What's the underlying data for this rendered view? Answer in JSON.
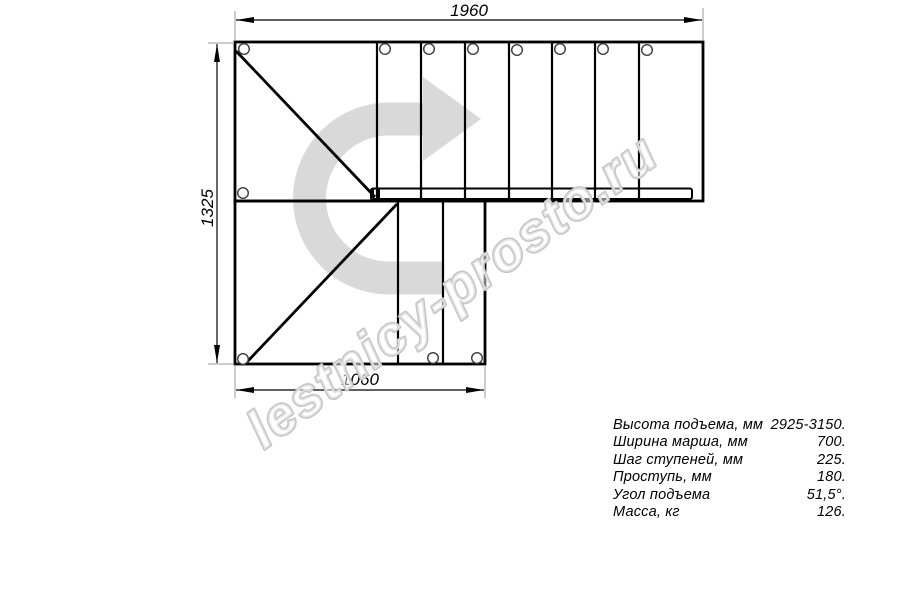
{
  "drawing": {
    "kind": "L-shaped staircase plan view",
    "dimensions": {
      "top": {
        "value": "1960"
      },
      "left": {
        "value": "1325"
      },
      "bottom": {
        "value": "1060"
      }
    },
    "direction_arrow": {
      "name": "direction-of-travel-arrow",
      "color": "#d9d9d9"
    },
    "colors": {
      "line": "#000000",
      "extension_line": "#9a9a9a",
      "hole_stroke": "#3c3c3c",
      "watermark": "#c6c6c6"
    }
  },
  "watermark": {
    "text": "lestnicy-prosto.ru",
    "color": "#c6c6c6"
  },
  "specs": {
    "rows": [
      {
        "label": "Высота подъема, мм",
        "value": "2925-3150."
      },
      {
        "label": "Ширина марша, мм",
        "value": "700."
      },
      {
        "label": "Шаг ступеней, мм",
        "value": "225."
      },
      {
        "label": "Проступь, мм",
        "value": "180."
      },
      {
        "label": "Угол подъема",
        "value": "51,5°."
      },
      {
        "label": "Масса, кг",
        "value": "126."
      }
    ]
  }
}
